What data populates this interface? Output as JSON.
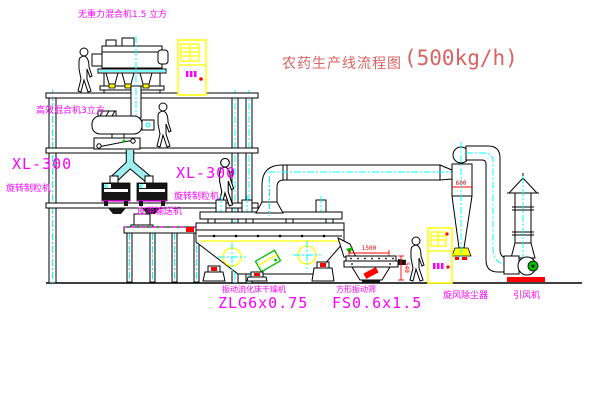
{
  "title": {
    "name": "农药生产线流程图",
    "capacity": "(500kg/h)"
  },
  "labels": {
    "top_mixer": "无重力混合机1.5 立方",
    "mid_mixer": "高效混合机3立方",
    "left_granulator_model": "XL-300",
    "left_granulator_name": "旋转制粒机",
    "right_granulator_model": "XL-300",
    "right_granulator_name": "旋转制粒机",
    "belt_conveyor": "皮带输送机",
    "dryer_name": "振动流化床干燥机",
    "dryer_model": "ZLG6x0.75",
    "sieve_name": "方形振动筛",
    "sieve_model": "FS0.6x1.5",
    "cyclone_name": "旋风除尘器",
    "fan_name": "引风机"
  },
  "dimensions": {
    "sieve_length": "1500",
    "sieve_height": "540",
    "cyclone_dim": "600"
  },
  "colors": {
    "magenta": "#ff00ff",
    "title_red": "#d96262",
    "dim_red": "#ff0000",
    "cad_yellow": "#ffff00",
    "cad_cyan": "#00ffff",
    "cad_green": "#00bb00",
    "line_black": "#000000",
    "background": "#ffffff"
  }
}
